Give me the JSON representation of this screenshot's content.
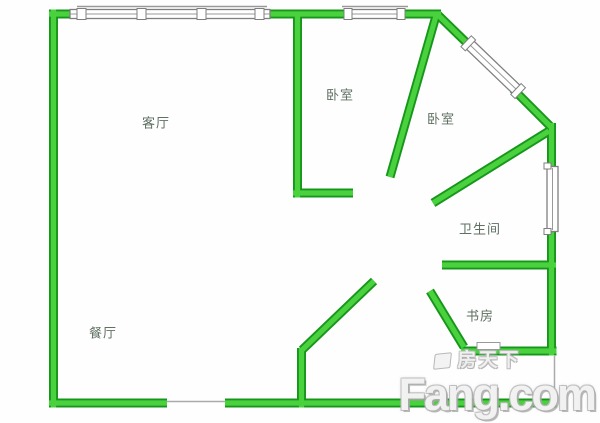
{
  "page": {
    "background": "#ffffff"
  },
  "floor_plan": {
    "colors": {
      "wall_fill": "#49d23d",
      "wall_edge": "#17961b",
      "window_outline": "#7f7f7f",
      "window_inner_line": "#999999",
      "opening_line": "#aaaaaa",
      "label_text": "#5f6f62"
    },
    "rooms": [
      {
        "name": "living-room",
        "label": "客厅"
      },
      {
        "name": "bedroom-top",
        "label": "卧室"
      },
      {
        "name": "bedroom-right",
        "label": "卧室"
      },
      {
        "name": "bathroom",
        "label": "卫生间"
      },
      {
        "name": "study",
        "label": "书房"
      },
      {
        "name": "dining-room",
        "label": "餐厅"
      }
    ]
  },
  "watermark": {
    "site_cn": "房天下",
    "site_en": "Fang.com"
  }
}
